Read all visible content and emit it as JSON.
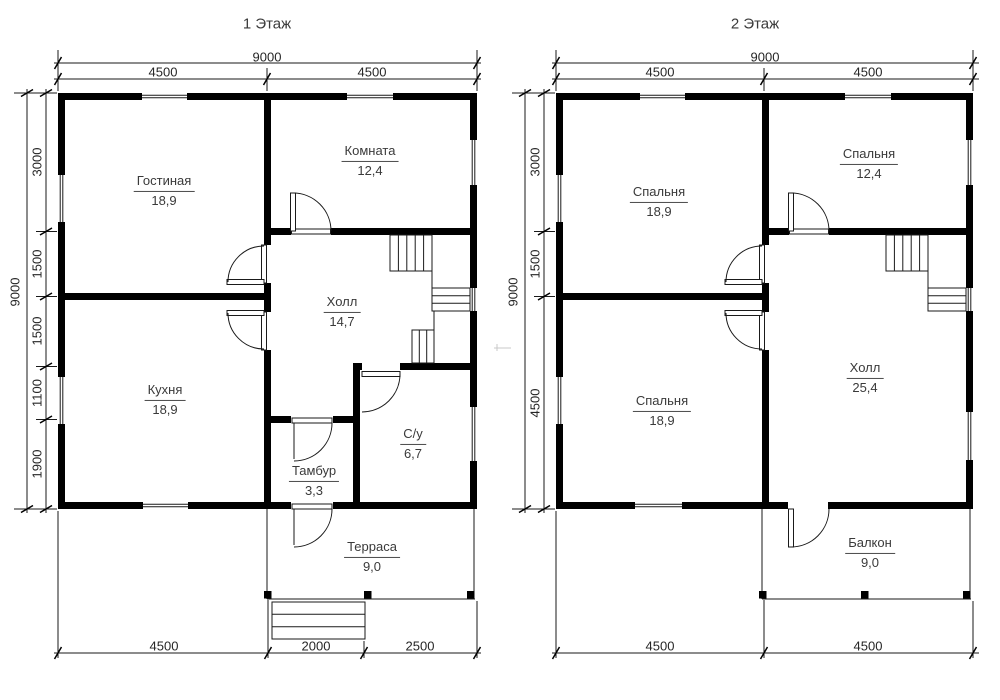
{
  "colors": {
    "background": "#ffffff",
    "walls": "#000000",
    "lines": "#1a1a1a",
    "text": "#3a3a3a",
    "dim_text": "#262626"
  },
  "plans": [
    {
      "title": "1 Этаж",
      "rooms": [
        {
          "name": "Гостиная",
          "area": "18,9"
        },
        {
          "name": "Комната",
          "area": "12,4"
        },
        {
          "name": "Холл",
          "area": "14,7"
        },
        {
          "name": "Кухня",
          "area": "18,9"
        },
        {
          "name": "Тамбур",
          "area": "3,3"
        },
        {
          "name": "С/у",
          "area": "6,7"
        },
        {
          "name": "Терраса",
          "area": "9,0"
        }
      ],
      "dims": {
        "top_total": "9000",
        "top_segments": [
          "4500",
          "4500"
        ],
        "side_total": "9000",
        "side_segments": [
          "3000",
          "1500",
          "1500",
          "1100",
          "1900"
        ],
        "bottom_segments": [
          "4500",
          "2000",
          "2500"
        ]
      }
    },
    {
      "title": "2 Этаж",
      "rooms": [
        {
          "name": "Спальня",
          "area": "18,9"
        },
        {
          "name": "Спальня",
          "area": "12,4"
        },
        {
          "name": "Спальня",
          "area": "18,9"
        },
        {
          "name": "Холл",
          "area": "25,4"
        },
        {
          "name": "Балкон",
          "area": "9,0"
        }
      ],
      "dims": {
        "top_total": "9000",
        "top_segments": [
          "4500",
          "4500"
        ],
        "side_total": "9000",
        "side_segments": [
          "3000",
          "1500",
          "4500"
        ],
        "bottom_segments": [
          "4500",
          "4500"
        ]
      }
    }
  ]
}
